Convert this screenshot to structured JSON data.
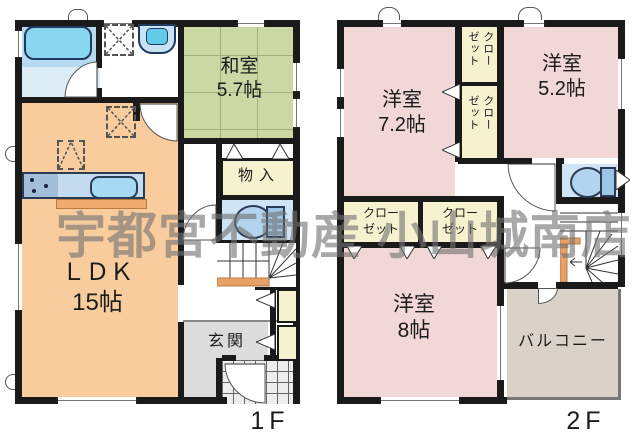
{
  "watermark": {
    "text": "宇都宮不動産 小山城南店",
    "color": "#8a8a8a"
  },
  "floor1": {
    "label": "1F",
    "washitsu": {
      "name": "和室",
      "size": "5.7帖"
    },
    "ldk": {
      "name": "ＬＤＫ",
      "size": "15帖"
    },
    "monoire": {
      "name": "物入"
    },
    "genkan": {
      "name": "玄関"
    }
  },
  "floor2": {
    "label": "2F",
    "room72": {
      "name": "洋室",
      "size": "7.2帖"
    },
    "room52": {
      "name": "洋室",
      "size": "5.2帖"
    },
    "room8": {
      "name": "洋室",
      "size": "8帖"
    },
    "closet": {
      "line1": "クロー",
      "line2": "ゼット"
    },
    "balcony": {
      "name": "バルコニー"
    }
  },
  "colors": {
    "wall": "#1a1a1a",
    "tatami": "#ccd8a4",
    "western_room": "#f1d7d5",
    "ldk": "#f8cc9c",
    "closet": "#f6f2cf",
    "balcony": "#d9d2c9",
    "genkan": "#dcdcdc",
    "water_area": "#b7d9f1",
    "stairs_accent": "#e8a069"
  }
}
